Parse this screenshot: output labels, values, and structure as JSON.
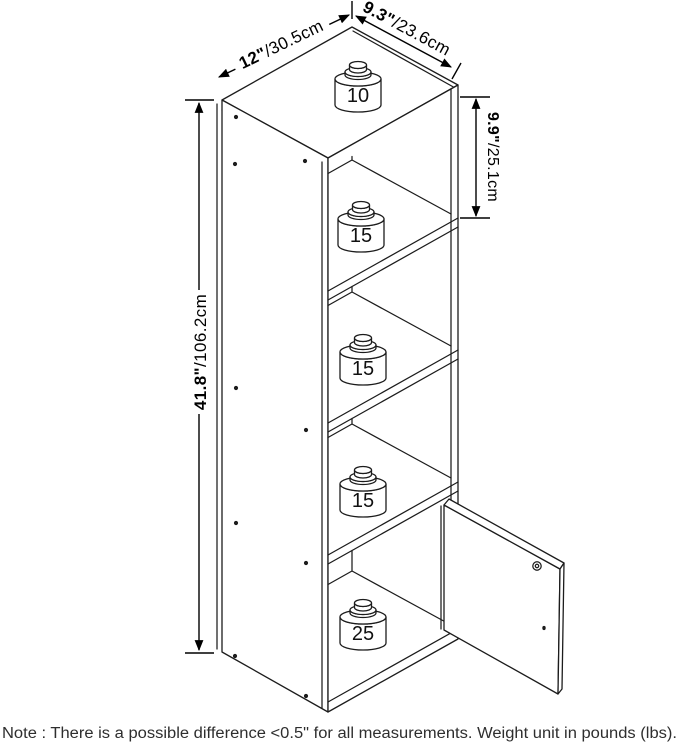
{
  "dimensions": {
    "width": {
      "value": "12\"",
      "metric": "/30.5cm"
    },
    "depth": {
      "value": "9.3\"",
      "metric": "/23.6cm"
    },
    "compartment_height": {
      "value": "9.9\"",
      "metric": "/25.1cm"
    },
    "overall_height": {
      "value": "41.8\"",
      "metric": "/106.2cm"
    }
  },
  "weight_capacities": {
    "top": "10",
    "shelf_1": "15",
    "shelf_2": "15",
    "shelf_3": "15",
    "bottom": "25"
  },
  "note": "Note : There is a possible difference <0.5\" for all measurements. Weight unit in pounds (lbs)."
}
